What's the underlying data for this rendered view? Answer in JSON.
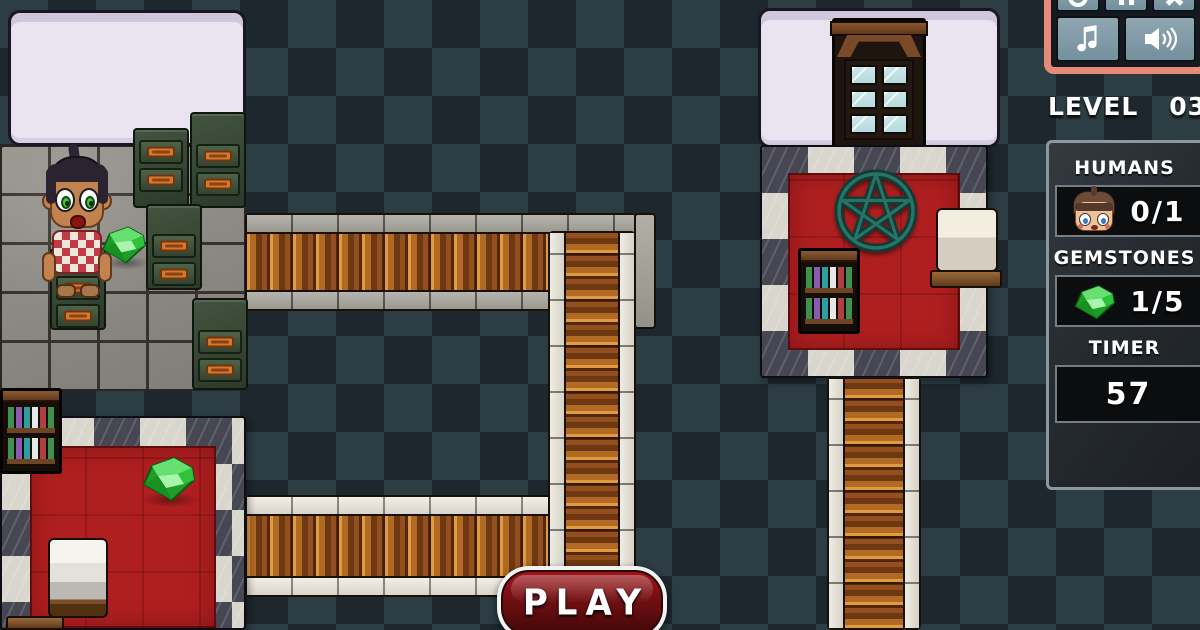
{
  "hud": {
    "level": {
      "label": "LEVEL",
      "value": "03"
    },
    "stats": [
      {
        "id": "humans",
        "title": "HUMANS",
        "value": "0/1",
        "icon": "human-face-icon"
      },
      {
        "id": "gemstones",
        "title": "GEMSTONES",
        "value": "1/5",
        "icon": "gemstone-icon"
      },
      {
        "id": "timer",
        "title": "TIMER",
        "value": "57",
        "icon": "none"
      }
    ]
  },
  "controls": {
    "top_row_icons": [
      "restart-icon",
      "pause-icon",
      "close-icon"
    ],
    "bottom_row_icons": [
      "music-note-icon",
      "speaker-icon"
    ]
  },
  "menu": {
    "play_label": "PLAY"
  },
  "scene": {
    "character": "human-kid-sprite",
    "gems_on_field": 2,
    "rooms": [
      "pentagram-ritual-room",
      "red-carpet-room"
    ],
    "paths": [
      "wooden-bridge-upper",
      "wooden-bridge-lower",
      "wooden-walkway-vertical",
      "wooden-walkway-below-ritual-room"
    ],
    "furniture": {
      "filing_cabinets": 5,
      "bookshelves": 2,
      "marble_blocks": 2,
      "glass_door": 1,
      "wall_panels": 2
    },
    "symbols": [
      "pentagram"
    ]
  },
  "colors": {
    "bg_dark": "#1d272d",
    "bg_light": "#2c3d43",
    "room_red": "#b01f20",
    "marble_light": "#d9d6cd",
    "marble_dark": "#474753",
    "wood_light": "#e09a3f",
    "wood_dark": "#6e3812",
    "stone": "#9b988f",
    "hud_panel": "#262b30",
    "frame_salmon": "#e88a79",
    "button_slate": "#7f98a4",
    "gem_green": "#22b32e",
    "play_red": "#7a1013"
  }
}
